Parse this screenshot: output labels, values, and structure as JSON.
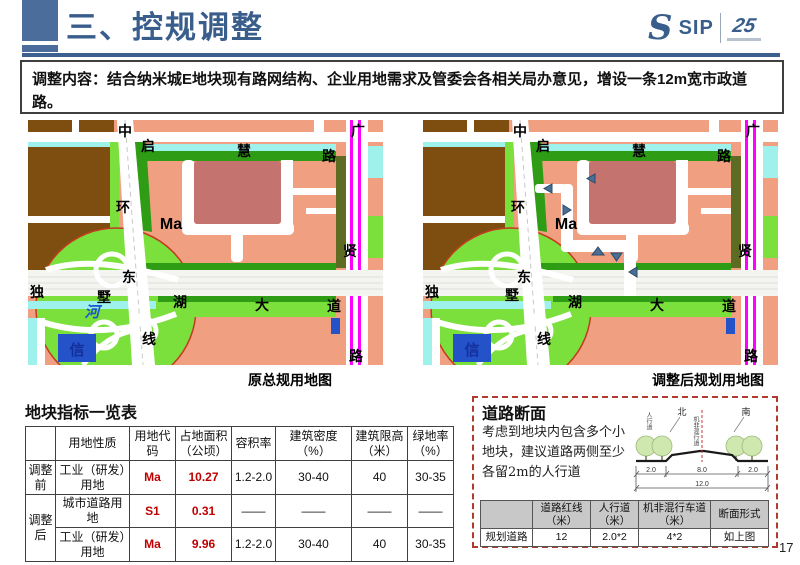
{
  "page": {
    "number": "17"
  },
  "header": {
    "title": "三、控规调整",
    "logo": {
      "s": "S",
      "sip": "SIP",
      "anniv": "25"
    }
  },
  "intro": {
    "text": "调整内容：结合纳米城E地块现有路网结构、企业用地需求及管委会各相关局办意见，增设一条12m宽市政道路。"
  },
  "maps": {
    "left_caption": "原总规用地图",
    "right_caption": "调整后规划用地图",
    "labels": {
      "zhonghuan": [
        "中",
        "环",
        "东",
        "线"
      ],
      "qihui": [
        "启",
        "慧",
        "路"
      ],
      "guangxian": [
        "广",
        "贤",
        "路"
      ],
      "dushuhu": [
        "独",
        "墅",
        "湖",
        "大",
        "道"
      ],
      "block": "Ma",
      "river": "河",
      "xin": "信"
    }
  },
  "indicator_table": {
    "title": "地块指标一览表",
    "headers": [
      "",
      "用地性质",
      "用地代码",
      "占地面积（公顷）",
      "容积率",
      "建筑密度（%）",
      "建筑限高（米）",
      "绿地率（%）"
    ],
    "rows": [
      {
        "stage": "调整前",
        "nature": "工业（研发）用地",
        "code": "Ma",
        "area": "10.27",
        "far": "1.2-2.0",
        "density": "30-40",
        "height": "40",
        "green": "30-35"
      },
      {
        "stage": "调整后",
        "nature": "城市道路用地",
        "code": "S1",
        "area": "0.31",
        "far": "——",
        "density": "——",
        "height": "——",
        "green": "——"
      },
      {
        "nature": "工业（研发）用地",
        "code": "Ma",
        "area": "9.96",
        "far": "1.2-2.0",
        "density": "30-40",
        "height": "40",
        "green": "30-35"
      }
    ]
  },
  "road_section": {
    "title": "道路断面",
    "note": "考虑到地块内包含多个小地块，建议道路两侧至少各留2m的人行道",
    "diagram": {
      "north": "北",
      "south": "南",
      "sidewalk": "人行道",
      "lane": "机非混行道",
      "dims": [
        "2.0",
        "8.0",
        "2.0"
      ],
      "total": "12.0"
    },
    "table": {
      "headers": [
        "",
        "道路红线（米）",
        "人行道（米）",
        "机非混行车道（米）",
        "断面形式"
      ],
      "row": [
        "规划道路",
        "12",
        "2.0*2",
        "4*2",
        "如上图"
      ]
    }
  },
  "colors": {
    "accent_blue": "#3A5E8C",
    "table_value_red": "#C00000",
    "dashed_box_red": "#B03A2E",
    "map": {
      "industrial_salmon": "#F0A080",
      "block_dark_red": "#C4736E",
      "village_brown": "#7D4E10",
      "green_bright": "#7CE03C",
      "green_dark": "#2E9C14",
      "water_cyan": "#9FF2EC",
      "rail_magenta": "#FF00FF",
      "marker_blue": "#4A6F96",
      "plot_blue": "#2453C9"
    }
  }
}
